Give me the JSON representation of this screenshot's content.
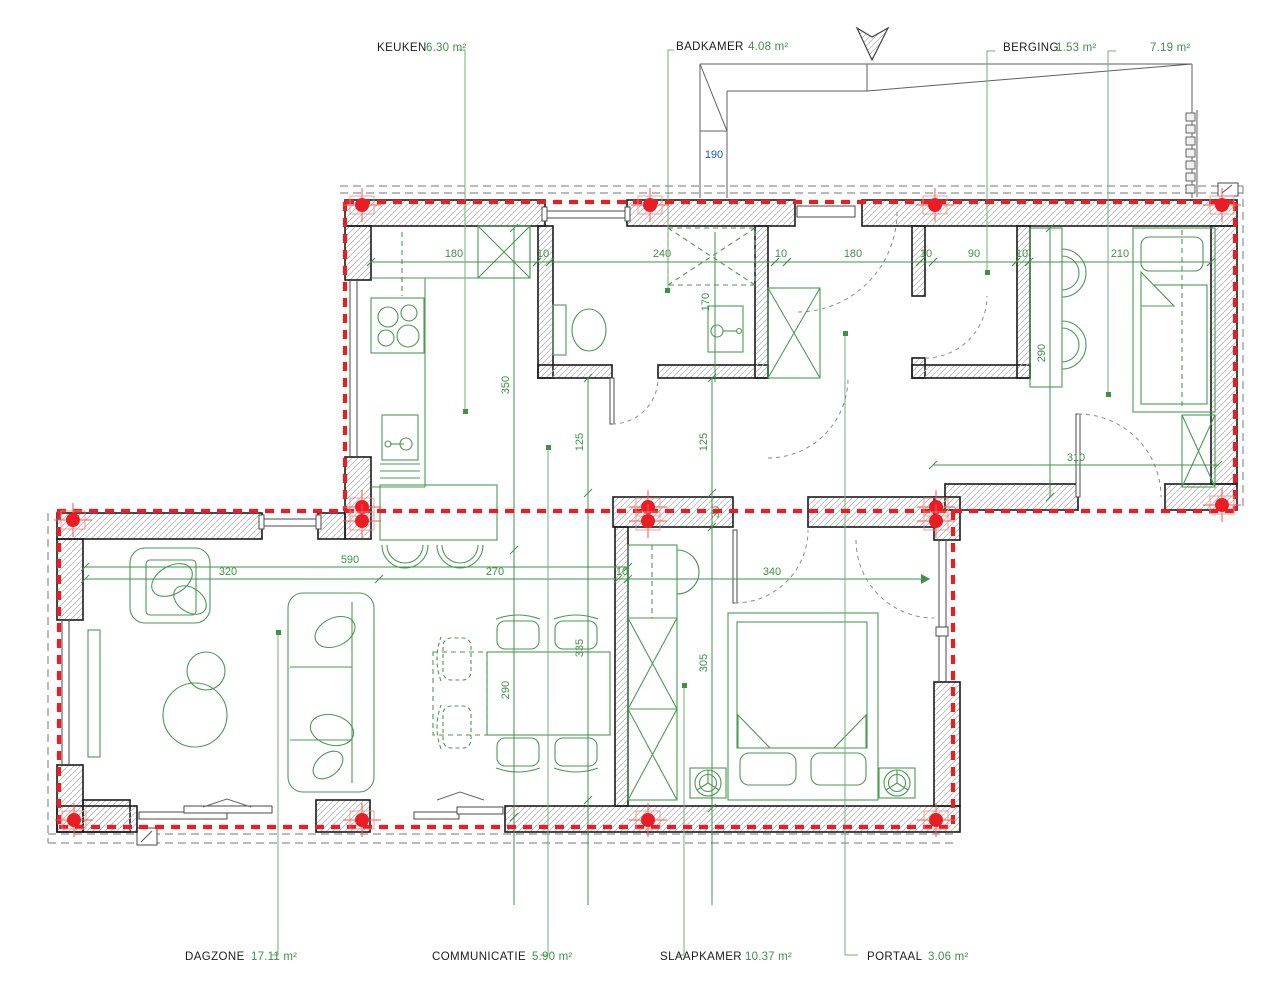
{
  "plan": {
    "type": "architectural floor plan",
    "colors": {
      "annotation_green": "#3f9148",
      "axis_red": "#ec1c24",
      "dimension_blue": "#1a56d6",
      "wall_outline": "#1a1a1a"
    },
    "symbols": [
      "north-arrow",
      "pier-markers",
      "roof-slope-lines"
    ],
    "rooms": [
      {
        "name": "KEUKEN",
        "area": "6.30 m²"
      },
      {
        "name": "BADKAMER",
        "area": "4.08 m²"
      },
      {
        "name": "BERGING",
        "area": "1.53 m²"
      },
      {
        "name": "",
        "area": "7.19 m²"
      },
      {
        "name": "DAGZONE",
        "area": "17.11 m²"
      },
      {
        "name": "COMMUNICATIE",
        "area": "5.90 m²"
      },
      {
        "name": "SLAAPKAMER",
        "area": "10.37 m²"
      },
      {
        "name": "PORTAAL",
        "area": "3.06 m²"
      }
    ],
    "dims": {
      "d180a": "180",
      "w10a": "10",
      "d240": "240",
      "w10b": "10",
      "d180b": "180",
      "w10c": "10",
      "d90": "90",
      "w10d": "10",
      "d210": "210",
      "v350": "350",
      "v290k": "290",
      "v170": "170",
      "v125a": "125",
      "v125b": "125",
      "v335": "335",
      "v305": "305",
      "v290b": "290",
      "h590": "590",
      "h320": "320",
      "h270": "270",
      "w10e": "10",
      "h340": "340",
      "h310": "310",
      "w30": "30",
      "b190": "190"
    }
  }
}
